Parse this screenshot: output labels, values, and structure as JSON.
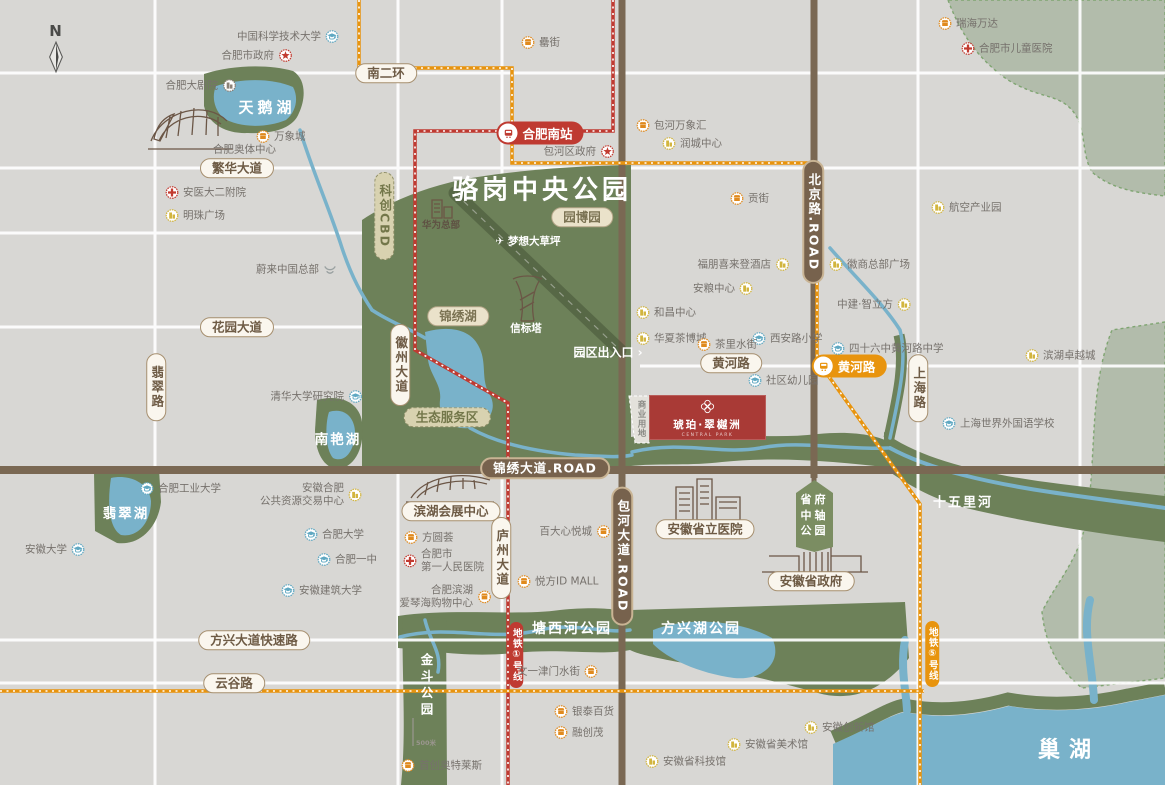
{
  "compass": "N",
  "project": {
    "name": "琥珀·翠樾洲",
    "tagline": "CENTRAL PARK"
  },
  "metro": {
    "hefei_south": "合肥南站",
    "huanghe": "黄河路",
    "line1": "地铁①号线",
    "line5": "地铁⑤号线"
  },
  "shield": {
    "lines": [
      "省府",
      "中轴",
      "公园"
    ]
  },
  "colors": {
    "metro_red": "#bf3a31",
    "metro_orange": "#e8940e",
    "park_green": "#6d8159",
    "water_blue": "#79b2ca",
    "road_brown": "#7a6853",
    "project_red": "#a93a36",
    "sage": "#b2bcab"
  },
  "areas": [
    {
      "t": "骆岗中央公园",
      "x": 542,
      "y": 188,
      "s": 26,
      "ls": 4
    },
    {
      "t": "天鹅湖",
      "x": 267,
      "y": 107,
      "s": 15,
      "ls": 4
    },
    {
      "t": "翡翠湖",
      "x": 126,
      "y": 512,
      "s": 13.5,
      "ls": 2
    },
    {
      "t": "南艳湖",
      "x": 338,
      "y": 438,
      "s": 13.5,
      "ls": 2
    },
    {
      "t": "塘西河公园",
      "x": 572,
      "y": 628,
      "s": 14,
      "ls": 2
    },
    {
      "t": "方兴湖公园",
      "x": 701,
      "y": 628,
      "s": 14,
      "ls": 2
    },
    {
      "t": "十五里河",
      "x": 963,
      "y": 501,
      "s": 13,
      "ls": 2
    },
    {
      "t": "巢湖",
      "x": 1069,
      "y": 748,
      "s": 22,
      "ls": 9
    },
    {
      "t": "金斗公园",
      "x": 426,
      "y": 686,
      "s": 12.5,
      "v": true
    },
    {
      "t": "梦想大草坪",
      "x": 528,
      "y": 241,
      "s": 10.5,
      "pre": "✈"
    },
    {
      "t": "信标塔",
      "x": 526,
      "y": 328,
      "s": 10.5
    },
    {
      "t": "园区出入口",
      "x": 608,
      "y": 352,
      "s": 12,
      "post": "›"
    },
    {
      "t": "华为总部",
      "x": 441,
      "y": 224,
      "s": 9.5,
      "c": "#5f5143"
    },
    {
      "t": "商业用地",
      "x": 641,
      "y": 419,
      "s": 8.5,
      "v": true,
      "c": "#8a8a85",
      "ls2": 1
    },
    {
      "t": "500米",
      "x": 426,
      "y": 742,
      "s": 6.5,
      "c": "#9b968f"
    }
  ],
  "pills": [
    {
      "t": "南二环",
      "x": 386,
      "y": 73,
      "st": "w"
    },
    {
      "t": "繁华大道",
      "x": 237,
      "y": 168,
      "st": "w"
    },
    {
      "t": "花园大道",
      "x": 237,
      "y": 327,
      "st": "w"
    },
    {
      "t": "黄河路",
      "x": 731,
      "y": 363,
      "st": "w"
    },
    {
      "t": "方兴大道快速路",
      "x": 254,
      "y": 640,
      "st": "w"
    },
    {
      "t": "云谷路",
      "x": 234,
      "y": 683,
      "st": "w"
    },
    {
      "t": "生态服务区",
      "x": 447,
      "y": 417,
      "st": "k"
    },
    {
      "t": "园博园",
      "x": 582,
      "y": 217,
      "st": "e"
    },
    {
      "t": "锦绣湖",
      "x": 458,
      "y": 316,
      "st": "e"
    },
    {
      "t": "锦绣大道.ROAD",
      "x": 545,
      "y": 468,
      "st": "b"
    },
    {
      "t": "翡翠路",
      "x": 156,
      "y": 387,
      "st": "w",
      "v": true
    },
    {
      "t": "徽州大道",
      "x": 400,
      "y": 365,
      "st": "w",
      "v": true
    },
    {
      "t": "庐州大道",
      "x": 501,
      "y": 558,
      "st": "w",
      "v": true
    },
    {
      "t": "上海路",
      "x": 918,
      "y": 388,
      "st": "w",
      "v": true
    },
    {
      "t": "北京路.ROAD",
      "x": 813,
      "y": 222,
      "st": "b",
      "v": true
    },
    {
      "t": "包河大道.ROAD",
      "x": 622,
      "y": 556,
      "st": "b",
      "v": true
    },
    {
      "t": "科创CBD",
      "x": 384,
      "y": 216,
      "st": "k",
      "v": true
    },
    {
      "t": "安徽省立医院",
      "x": 705,
      "y": 529,
      "st": "w"
    },
    {
      "t": "安徽省政府",
      "x": 811,
      "y": 581,
      "st": "w"
    },
    {
      "t": "滨湖会展中心",
      "x": 451,
      "y": 511,
      "st": "w"
    }
  ],
  "pois": [
    {
      "t": "中国科学技术大学",
      "i": "school",
      "x": 332,
      "y": 36,
      "s": "l"
    },
    {
      "t": "合肥市政府",
      "i": "gov",
      "x": 285,
      "y": 55,
      "s": "l"
    },
    {
      "t": "合肥大剧院",
      "i": "theater",
      "x": 229,
      "y": 85,
      "s": "l"
    },
    {
      "t": "万象城",
      "i": "mall",
      "x": 263,
      "y": 136,
      "s": "r"
    },
    {
      "t": "合肥奥体中心",
      "i": "",
      "x": 220,
      "y": 149,
      "s": "r"
    },
    {
      "t": "安医大二附院",
      "i": "hosp",
      "x": 172,
      "y": 192,
      "s": "r"
    },
    {
      "t": "明珠广场",
      "i": "biz",
      "x": 172,
      "y": 215,
      "s": "r"
    },
    {
      "t": "瑞海万达",
      "i": "mall",
      "x": 945,
      "y": 23,
      "s": "r"
    },
    {
      "t": "合肥市儿童医院",
      "i": "hosp",
      "x": 968,
      "y": 48,
      "s": "r"
    },
    {
      "t": "罍街",
      "i": "mall",
      "x": 528,
      "y": 42,
      "s": "r"
    },
    {
      "t": "包河万象汇",
      "i": "mall",
      "x": 643,
      "y": 125,
      "s": "r"
    },
    {
      "t": "润城中心",
      "i": "biz",
      "x": 669,
      "y": 143,
      "s": "r"
    },
    {
      "t": "包河区政府",
      "i": "gov",
      "x": 607,
      "y": 151,
      "s": "l"
    },
    {
      "t": "贡街",
      "i": "mall",
      "x": 737,
      "y": 198,
      "s": "r"
    },
    {
      "t": "航空产业园",
      "i": "biz",
      "x": 938,
      "y": 207,
      "s": "r"
    },
    {
      "t": "福朋喜来登酒店",
      "i": "biz",
      "x": 782,
      "y": 264,
      "s": "l"
    },
    {
      "t": "徽商总部广场",
      "i": "biz",
      "x": 836,
      "y": 264,
      "s": "r"
    },
    {
      "t": "安粮中心",
      "i": "biz",
      "x": 746,
      "y": 288,
      "s": "l"
    },
    {
      "t": "中建·智立方",
      "i": "biz",
      "x": 904,
      "y": 304,
      "s": "l"
    },
    {
      "t": "和昌中心",
      "i": "biz",
      "x": 643,
      "y": 312,
      "s": "r"
    },
    {
      "t": "华夏茶博城",
      "i": "biz",
      "x": 643,
      "y": 338,
      "s": "r"
    },
    {
      "t": "西安路小学",
      "i": "school",
      "x": 759,
      "y": 338,
      "s": "r"
    },
    {
      "t": "四十六中黄河路中学",
      "i": "school",
      "x": 838,
      "y": 348,
      "s": "r"
    },
    {
      "t": "茶里水街",
      "i": "mall",
      "x": 704,
      "y": 344,
      "s": "r"
    },
    {
      "t": "滨湖卓越城",
      "i": "biz",
      "x": 1032,
      "y": 355,
      "s": "r"
    },
    {
      "t": "社区幼儿园",
      "i": "school",
      "x": 755,
      "y": 380,
      "s": "r"
    },
    {
      "t": "上海世界外国语学校",
      "i": "school",
      "x": 949,
      "y": 423,
      "s": "r"
    },
    {
      "t": "蔚来中国总部",
      "i": "nio",
      "x": 330,
      "y": 269,
      "s": "l"
    },
    {
      "t": "清华大学研究院",
      "i": "school",
      "x": 355,
      "y": 396,
      "s": "l"
    },
    {
      "t": "合肥工业大学",
      "i": "school",
      "x": 147,
      "y": 488,
      "s": "r"
    },
    {
      "l": [
        "安徽合肥",
        "公共资源交易中心"
      ],
      "i": "biz",
      "x": 355,
      "y": 495,
      "s": "l",
      "a": "r"
    },
    {
      "t": "合肥大学",
      "i": "school",
      "x": 311,
      "y": 534,
      "s": "r"
    },
    {
      "t": "合肥一中",
      "i": "school",
      "x": 324,
      "y": 559,
      "s": "r"
    },
    {
      "t": "安徽建筑大学",
      "i": "school",
      "x": 288,
      "y": 590,
      "s": "r"
    },
    {
      "t": "安徽大学",
      "i": "school",
      "x": 78,
      "y": 549,
      "s": "l"
    },
    {
      "t": "方圆荟",
      "i": "mall",
      "x": 411,
      "y": 537,
      "s": "r"
    },
    {
      "l": [
        "合肥市",
        "第一人民医院"
      ],
      "i": "hosp",
      "x": 410,
      "y": 561,
      "s": "r"
    },
    {
      "l": [
        "合肥滨湖",
        "爱琴海购物中心"
      ],
      "i": "mall",
      "x": 484,
      "y": 597,
      "s": "l",
      "a": "r"
    },
    {
      "t": "百大心悦城",
      "i": "mall",
      "x": 603,
      "y": 531,
      "s": "l"
    },
    {
      "t": "悦方ID MALL",
      "i": "mall",
      "x": 524,
      "y": 581,
      "s": "r"
    },
    {
      "t": "文一津门水街",
      "i": "mall",
      "x": 591,
      "y": 671,
      "s": "l"
    },
    {
      "t": "首创奥特莱斯",
      "i": "mall",
      "x": 408,
      "y": 765,
      "s": "r"
    },
    {
      "t": "银泰百货",
      "i": "mall",
      "x": 561,
      "y": 711,
      "s": "r"
    },
    {
      "t": "融创茂",
      "i": "mall",
      "x": 561,
      "y": 732,
      "s": "r"
    },
    {
      "t": "安徽创新馆",
      "i": "biz",
      "x": 811,
      "y": 727,
      "s": "r"
    },
    {
      "t": "安徽省美术馆",
      "i": "biz",
      "x": 734,
      "y": 744,
      "s": "r"
    },
    {
      "t": "安徽省科技馆",
      "i": "biz",
      "x": 652,
      "y": 761,
      "s": "r"
    }
  ]
}
